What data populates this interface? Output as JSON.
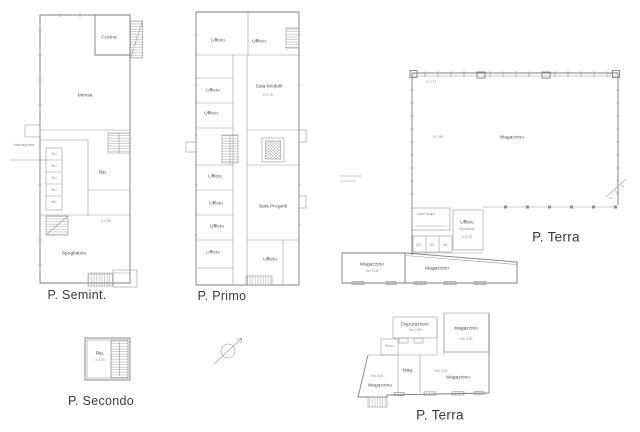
{
  "page": {
    "background": "#ffffff",
    "line_color": "#8f8f8f",
    "label_color": "#4e4e4e"
  },
  "plans": {
    "semint": {
      "title": "P. Semint."
    },
    "primo": {
      "title": "P. Primo"
    },
    "terra_big": {
      "title": "P. Terra"
    },
    "secondo": {
      "title": "P. Secondo"
    },
    "terra_small": {
      "title": "P. Terra"
    }
  },
  "labels": {
    "cucina": "Cucina",
    "mensa": "Mensa",
    "rip": "Rip.",
    "spogliatoio": "Spogliatoio",
    "wc": "WC",
    "intercapedine": "Intercapedine",
    "quota_semint": "± 1.98",
    "ufficio": "Ufficio",
    "sala_modelli": "Sala Modelli",
    "sala_modelli_h": "H 2.70",
    "sala_progetti": "Sala Progetti",
    "magazzino": "Magazzino",
    "sala_pompe": "Sala Pompe",
    "spedizioni": "Spedizioni",
    "ufficio_sped_h": "H 3.10",
    "hall_h_top": "H 7.77",
    "hall_h_mid": "H 7.80",
    "magazzino_annex_h": "Hm 3.08",
    "quota_secondo": "± 2.30",
    "depurazione": "Depurazione",
    "depurazione_h": "Hm 2.55",
    "magazzino_tr_h": "Hm 2.80",
    "pesa": "Pesa",
    "mag": "Mag.",
    "magazzino_h": "Hm 3.00"
  }
}
